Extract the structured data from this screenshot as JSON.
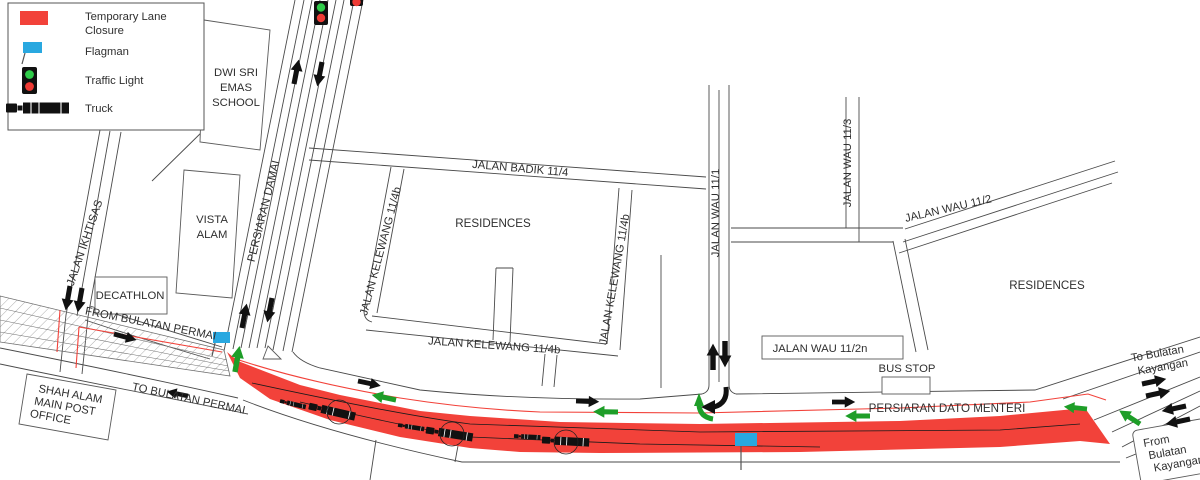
{
  "title": "Temporary lane closure traffic management diagram",
  "colors": {
    "closure_red": "#F2423A",
    "arrow_black": "#111111",
    "arrow_green": "#1E9E28",
    "flag_blue": "#29A8E0",
    "signal_green": "#2FCC4A",
    "signal_red": "#EF3B35",
    "road_line": "#4a4a4a",
    "hatch_line": "#8a8a8a",
    "text": "#2f2f2f"
  },
  "legend": {
    "items": [
      {
        "icon": "closure-swatch",
        "label_lines": [
          "Temporary Lane",
          "Closure"
        ]
      },
      {
        "icon": "flag-icon",
        "label": "Flagman"
      },
      {
        "icon": "traffic-light-icon",
        "label": "Traffic Light"
      },
      {
        "icon": "truck-icon",
        "label": "Truck"
      }
    ]
  },
  "labels": {
    "school": [
      "DWI SRI",
      "EMAS",
      "SCHOOL"
    ],
    "vista_alam": [
      "VISTA",
      "ALAM"
    ],
    "decathlon": "DECATHLON",
    "jalan_ikhtisas": "JALAN IKHTISAS",
    "persiaran_damai": "PERSIARAN DAMAI",
    "from_bulatan_permai": "FROM BULATAN PERMAI",
    "to_bulatan_permai": "TO BULATAN PERMAI",
    "post_office": [
      "SHAH ALAM",
      "MAIN POST",
      "OFFICE"
    ],
    "jalan_badik": "JALAN BADIK 11/4",
    "kelewang_left": "JALAN KELEWANG 11/4b",
    "kelewang_right": "JALAN KELEWANG 11/4b",
    "kelewang_bottom": "JALAN KELEWANG 11/4b",
    "residences_left": "RESIDENCES",
    "residences_right": "RESIDENCES",
    "jalan_wau_11_1": "JALAN WAU 11/1",
    "jalan_wau_11_3": "JALAN WAU 11/3",
    "jalan_wau_11_2": "JALAN WAU 11/2",
    "jalan_wau_11_2n": "JALAN WAU 11/2n",
    "bus_stop": "BUS STOP",
    "persiaran_dato_menteri": "PERSIARAN DATO MENTERI",
    "to_bulatan_kayangan": [
      "To Bulatan",
      "Kayangan"
    ],
    "from_bulatan_kayangan": [
      "From",
      "Bulatan",
      "Kayangan"
    ]
  }
}
